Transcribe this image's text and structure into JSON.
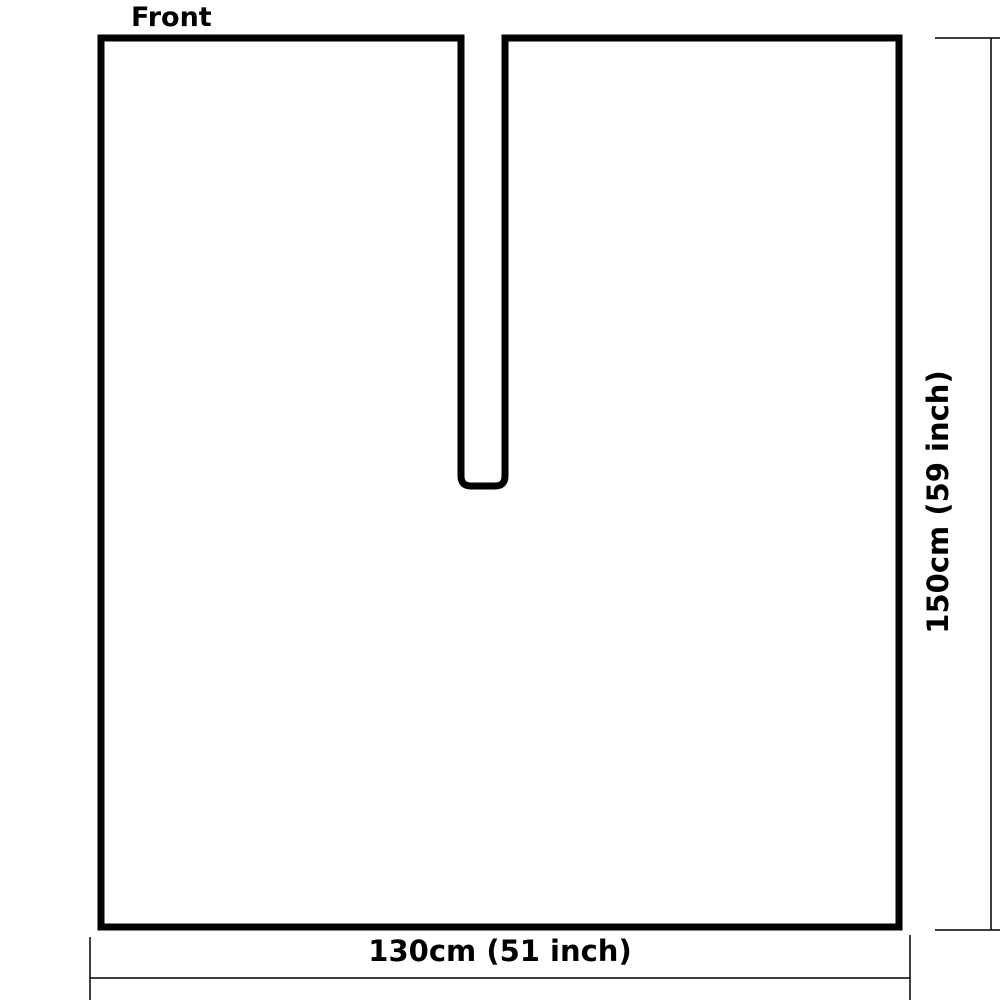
{
  "diagram": {
    "front_label": "Front",
    "width_label": "130cm (51 inch)",
    "height_label": "150cm (59 inch)",
    "shape": "rectangular panel with center neck slit",
    "outline_stroke_px": 7,
    "dimension_stroke_px": 1.5
  },
  "colors": {
    "outline": "#000000",
    "dimension_line": "#000000",
    "text": "#000000",
    "background": "#ffffff",
    "panel_fill": "#ffffff"
  }
}
